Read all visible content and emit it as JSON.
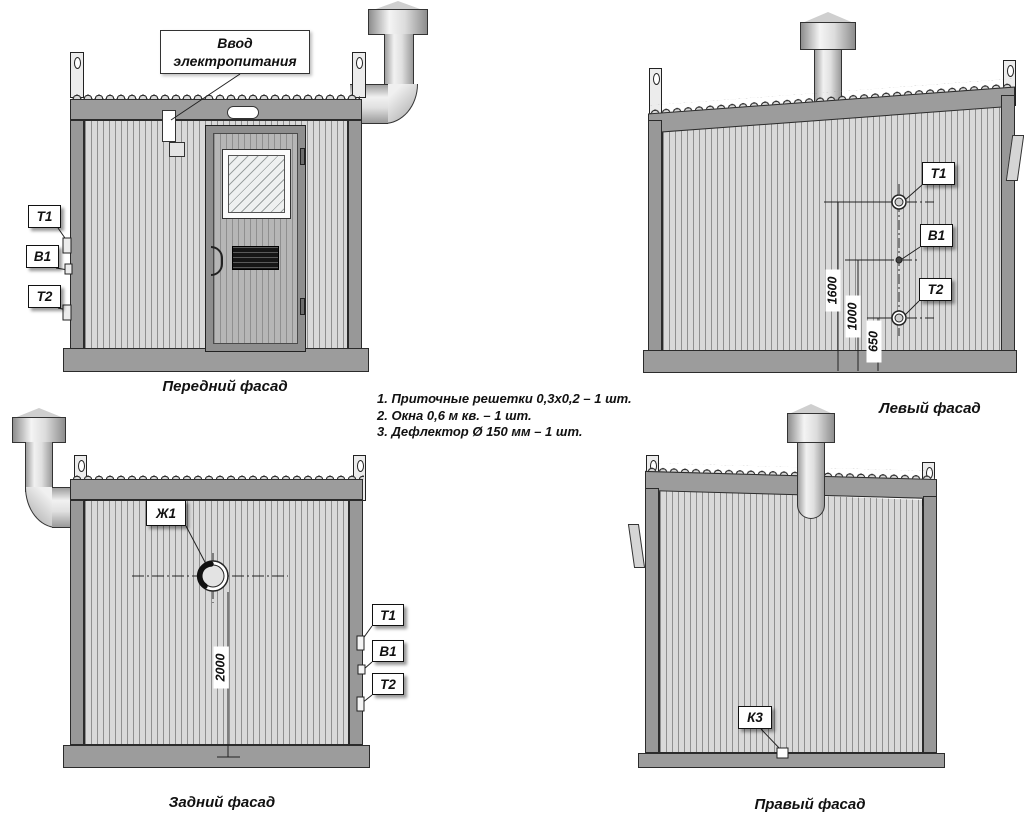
{
  "notes": {
    "line1": "1. Приточные решетки 0,3х0,2 – 1 шт.",
    "line2": "2. Окна 0,6 м кв. – 1 шт.",
    "line3": "3. Дефлектор Ø 150 мм – 1 шт."
  },
  "callout": {
    "line1": "Ввод",
    "line2": "электропитания"
  },
  "facades": {
    "front": {
      "caption": "Передний фасад",
      "tags": {
        "t1": "Т1",
        "b1": "В1",
        "t2": "Т2"
      }
    },
    "left": {
      "caption": "Левый фасад",
      "tags": {
        "t1": "Т1",
        "b1": "В1",
        "t2": "Т2"
      },
      "dims": {
        "h_t1": "1600",
        "h_b1": "1000",
        "h_t2": "650"
      }
    },
    "rear": {
      "caption": "Задний фасад",
      "tags": {
        "zh1": "Ж1",
        "t1": "Т1",
        "b1": "В1",
        "t2": "Т2"
      },
      "dims": {
        "h_zh1": "2000"
      }
    },
    "right": {
      "caption": "Правый фасад",
      "tags": {
        "k3": "К3"
      }
    }
  },
  "colors": {
    "wall": "#d9d9d9",
    "frame": "#9c9c9c",
    "corrugation_line": "#8f8f8f",
    "ink": "#222222"
  }
}
